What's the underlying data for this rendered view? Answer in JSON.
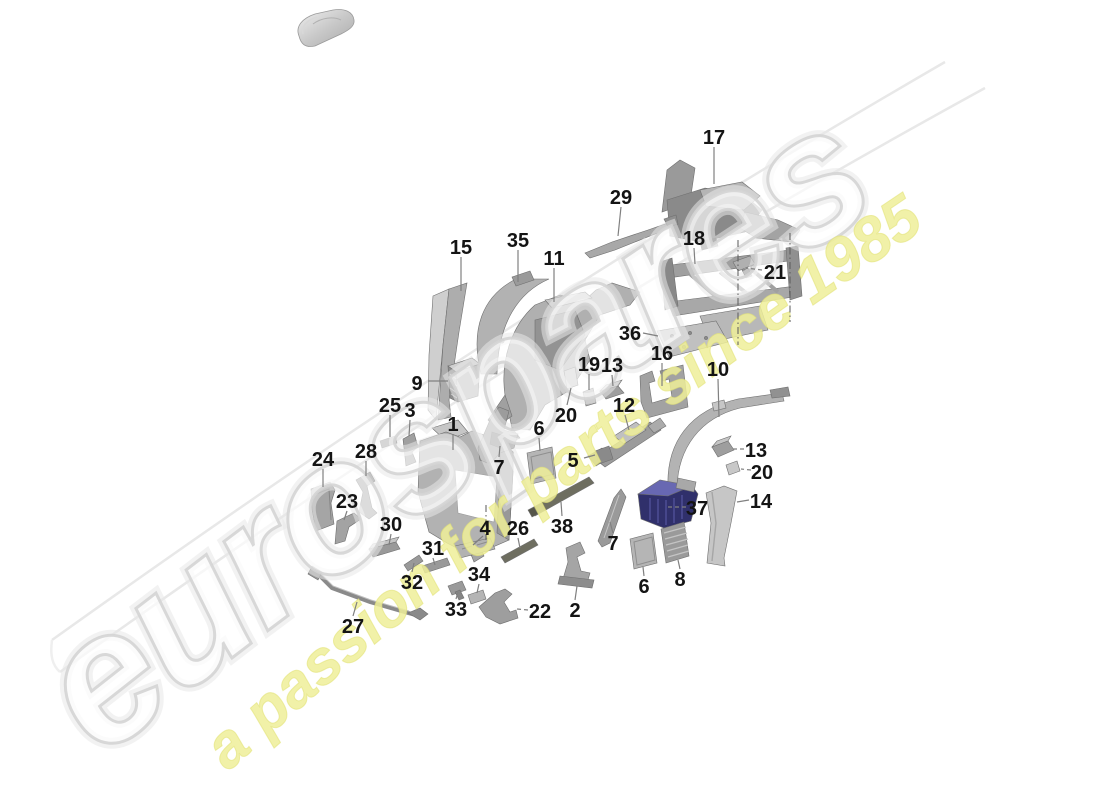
{
  "page": {
    "width": 1100,
    "height": 800,
    "background": "#ffffff"
  },
  "watermark": {
    "brand": "eurospares",
    "tagline": "a passion for parts since 1985",
    "brand_fill": "rgba(255,255,255,0.65)",
    "brand_stroke": "#d4d4d4",
    "tagline_fill": "#eeee99",
    "swoosh_stroke": "#e8e8e8"
  },
  "car_icon": {
    "name": "car-top-view"
  },
  "colors": {
    "part_base": "#b5b5b5",
    "part_dark": "#8d8d8d",
    "part_light": "#d4d4d4",
    "part_navy": "#30306b",
    "leader": "#808080",
    "label_text": "#141414"
  },
  "aux_lines": [
    {
      "x1": 738,
      "y1": 240,
      "x2": 738,
      "y2": 345
    },
    {
      "x1": 790,
      "y1": 233,
      "x2": 790,
      "y2": 322
    },
    {
      "x1": 486,
      "y1": 505,
      "x2": 486,
      "y2": 540
    }
  ],
  "labels": [
    {
      "num": "17",
      "x": 714,
      "y": 137,
      "lx1": 714,
      "ly1": 147,
      "lx2": 714,
      "ly2": 184,
      "dash": false
    },
    {
      "num": "29",
      "x": 621,
      "y": 197,
      "lx1": 621,
      "ly1": 207,
      "lx2": 618,
      "ly2": 236,
      "dash": false
    },
    {
      "num": "15",
      "x": 461,
      "y": 247,
      "lx1": 461,
      "ly1": 257,
      "lx2": 461,
      "ly2": 291,
      "dash": false
    },
    {
      "num": "35",
      "x": 518,
      "y": 240,
      "lx1": 518,
      "ly1": 250,
      "lx2": 518,
      "ly2": 282,
      "dash": false
    },
    {
      "num": "11",
      "x": 554,
      "y": 258,
      "lx1": 554,
      "ly1": 268,
      "lx2": 554,
      "ly2": 302,
      "dash": false
    },
    {
      "num": "18",
      "x": 694,
      "y": 238,
      "lx1": 694,
      "ly1": 248,
      "lx2": 695,
      "ly2": 264,
      "dash": false
    },
    {
      "num": "21",
      "x": 775,
      "y": 272,
      "lx1": 762,
      "ly1": 270,
      "lx2": 746,
      "ly2": 268,
      "dash": true
    },
    {
      "num": "36",
      "x": 630,
      "y": 333,
      "lx1": 643,
      "ly1": 333,
      "lx2": 658,
      "ly2": 336,
      "dash": false
    },
    {
      "num": "16",
      "x": 662,
      "y": 353,
      "lx1": 662,
      "ly1": 363,
      "lx2": 662,
      "ly2": 386,
      "dash": false
    },
    {
      "num": "19",
      "x": 589,
      "y": 364,
      "lx1": 589,
      "ly1": 374,
      "lx2": 589,
      "ly2": 390,
      "dash": false
    },
    {
      "num": "13",
      "x": 612,
      "y": 365,
      "lx1": 612,
      "ly1": 375,
      "lx2": 613,
      "ly2": 386,
      "dash": false
    },
    {
      "num": "10",
      "x": 718,
      "y": 369,
      "lx1": 718,
      "ly1": 379,
      "lx2": 719,
      "ly2": 417,
      "dash": false
    },
    {
      "num": "20",
      "x": 566,
      "y": 415,
      "lx1": 567,
      "ly1": 405,
      "lx2": 571,
      "ly2": 388,
      "dash": false
    },
    {
      "num": "12",
      "x": 624,
      "y": 405,
      "lx1": 625,
      "ly1": 415,
      "lx2": 629,
      "ly2": 430,
      "dash": false
    },
    {
      "num": "9",
      "x": 417,
      "y": 383,
      "lx1": 428,
      "ly1": 381,
      "lx2": 448,
      "ly2": 381,
      "dash": false
    },
    {
      "num": "25",
      "x": 390,
      "y": 405,
      "lx1": 390,
      "ly1": 415,
      "lx2": 390,
      "ly2": 437,
      "dash": false
    },
    {
      "num": "3",
      "x": 410,
      "y": 410,
      "lx1": 410,
      "ly1": 420,
      "lx2": 409,
      "ly2": 436,
      "dash": false
    },
    {
      "num": "1",
      "x": 453,
      "y": 424,
      "lx1": 453,
      "ly1": 434,
      "lx2": 453,
      "ly2": 450,
      "dash": false
    },
    {
      "num": "6",
      "x": 539,
      "y": 428,
      "lx1": 539,
      "ly1": 438,
      "lx2": 540,
      "ly2": 451,
      "dash": false
    },
    {
      "num": "7",
      "x": 499,
      "y": 467,
      "lx1": 499,
      "ly1": 457,
      "lx2": 500,
      "ly2": 446,
      "dash": false
    },
    {
      "num": "5",
      "x": 573,
      "y": 460,
      "lx1": 584,
      "ly1": 458,
      "lx2": 595,
      "ly2": 455,
      "dash": false
    },
    {
      "num": "4",
      "x": 485,
      "y": 528,
      "lx1": 483,
      "ly1": 536,
      "lx2": 473,
      "ly2": 545,
      "dash": false
    },
    {
      "num": "26",
      "x": 518,
      "y": 528,
      "lx1": 518,
      "ly1": 538,
      "lx2": 520,
      "ly2": 548,
      "dash": false
    },
    {
      "num": "38",
      "x": 562,
      "y": 526,
      "lx1": 562,
      "ly1": 516,
      "lx2": 561,
      "ly2": 502,
      "dash": false
    },
    {
      "num": "37",
      "x": 697,
      "y": 508,
      "lx1": 686,
      "ly1": 507,
      "lx2": 668,
      "ly2": 507,
      "dash": true
    },
    {
      "num": "13",
      "x": 756,
      "y": 450,
      "lx1": 744,
      "ly1": 449,
      "lx2": 733,
      "ly2": 449,
      "dash": true
    },
    {
      "num": "20",
      "x": 762,
      "y": 472,
      "lx1": 751,
      "ly1": 470,
      "lx2": 741,
      "ly2": 469,
      "dash": true
    },
    {
      "num": "14",
      "x": 761,
      "y": 501,
      "lx1": 749,
      "ly1": 500,
      "lx2": 737,
      "ly2": 502,
      "dash": false
    },
    {
      "num": "7",
      "x": 613,
      "y": 543,
      "lx1": 613,
      "ly1": 533,
      "lx2": 610,
      "ly2": 522,
      "dash": false
    },
    {
      "num": "2",
      "x": 575,
      "y": 610,
      "lx1": 575,
      "ly1": 600,
      "lx2": 577,
      "ly2": 586,
      "dash": false
    },
    {
      "num": "22",
      "x": 540,
      "y": 611,
      "lx1": 528,
      "ly1": 610,
      "lx2": 517,
      "ly2": 609,
      "dash": true
    },
    {
      "num": "6",
      "x": 644,
      "y": 586,
      "lx1": 644,
      "ly1": 576,
      "lx2": 643,
      "ly2": 567,
      "dash": false
    },
    {
      "num": "8",
      "x": 680,
      "y": 579,
      "lx1": 680,
      "ly1": 569,
      "lx2": 678,
      "ly2": 560,
      "dash": false
    },
    {
      "num": "24",
      "x": 323,
      "y": 459,
      "lx1": 323,
      "ly1": 469,
      "lx2": 323,
      "ly2": 487,
      "dash": false
    },
    {
      "num": "28",
      "x": 366,
      "y": 451,
      "lx1": 366,
      "ly1": 461,
      "lx2": 366,
      "ly2": 476,
      "dash": false
    },
    {
      "num": "23",
      "x": 347,
      "y": 501,
      "lx1": 347,
      "ly1": 511,
      "lx2": 344,
      "ly2": 520,
      "dash": false
    },
    {
      "num": "30",
      "x": 391,
      "y": 524,
      "lx1": 391,
      "ly1": 534,
      "lx2": 389,
      "ly2": 545,
      "dash": false
    },
    {
      "num": "31",
      "x": 433,
      "y": 548,
      "lx1": 433,
      "ly1": 558,
      "lx2": 435,
      "ly2": 565,
      "dash": false
    },
    {
      "num": "32",
      "x": 412,
      "y": 582,
      "lx1": 412,
      "ly1": 572,
      "lx2": 414,
      "ly2": 563,
      "dash": false
    },
    {
      "num": "33",
      "x": 456,
      "y": 609,
      "lx1": 456,
      "ly1": 599,
      "lx2": 458,
      "ly2": 592,
      "dash": false
    },
    {
      "num": "34",
      "x": 479,
      "y": 574,
      "lx1": 479,
      "ly1": 584,
      "lx2": 477,
      "ly2": 593,
      "dash": false
    },
    {
      "num": "27",
      "x": 353,
      "y": 626,
      "lx1": 353,
      "ly1": 616,
      "lx2": 357,
      "ly2": 602,
      "dash": false
    }
  ]
}
